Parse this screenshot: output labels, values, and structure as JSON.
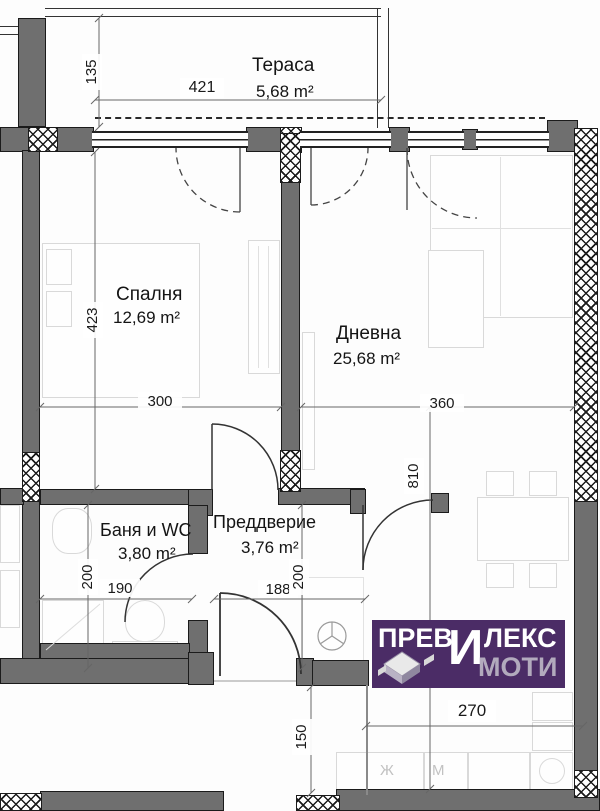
{
  "plan": {
    "rooms": [
      {
        "name": "Тераса",
        "area": "5,68 m²"
      },
      {
        "name": "Спалня",
        "area": "12,69 m²"
      },
      {
        "name": "Дневна",
        "area": "25,68 m²"
      },
      {
        "name": "Баня и WC",
        "area": "3,80 m²"
      },
      {
        "name": "Преддверие",
        "area": "3,76 m²"
      }
    ],
    "dims": {
      "terrace_width": "421",
      "terrace_depth": "135",
      "bedroom_depth": "423",
      "bedroom_width": "300",
      "living_width": "360",
      "living_depth": "810",
      "bath_depth": "200",
      "bath_width": "190",
      "hall_width": "188",
      "hall_depth": "200",
      "kitchen_width": "270",
      "bottom_offset": "150"
    },
    "kitchen": {
      "fridge": "Ж",
      "washer": "М"
    },
    "logo": {
      "word1_left": "ПРЕВ",
      "word1_big": "И",
      "word1_right": "ЛЕКС",
      "word2": "МОТИ",
      "bg_color": "#4b2c66",
      "text_color": "#ffffff",
      "text2_color": "#b2aabd"
    },
    "colors": {
      "wall": "#6f6f6f",
      "outline": "#1b1b1b",
      "dim_text": "#1a1a1a"
    }
  }
}
